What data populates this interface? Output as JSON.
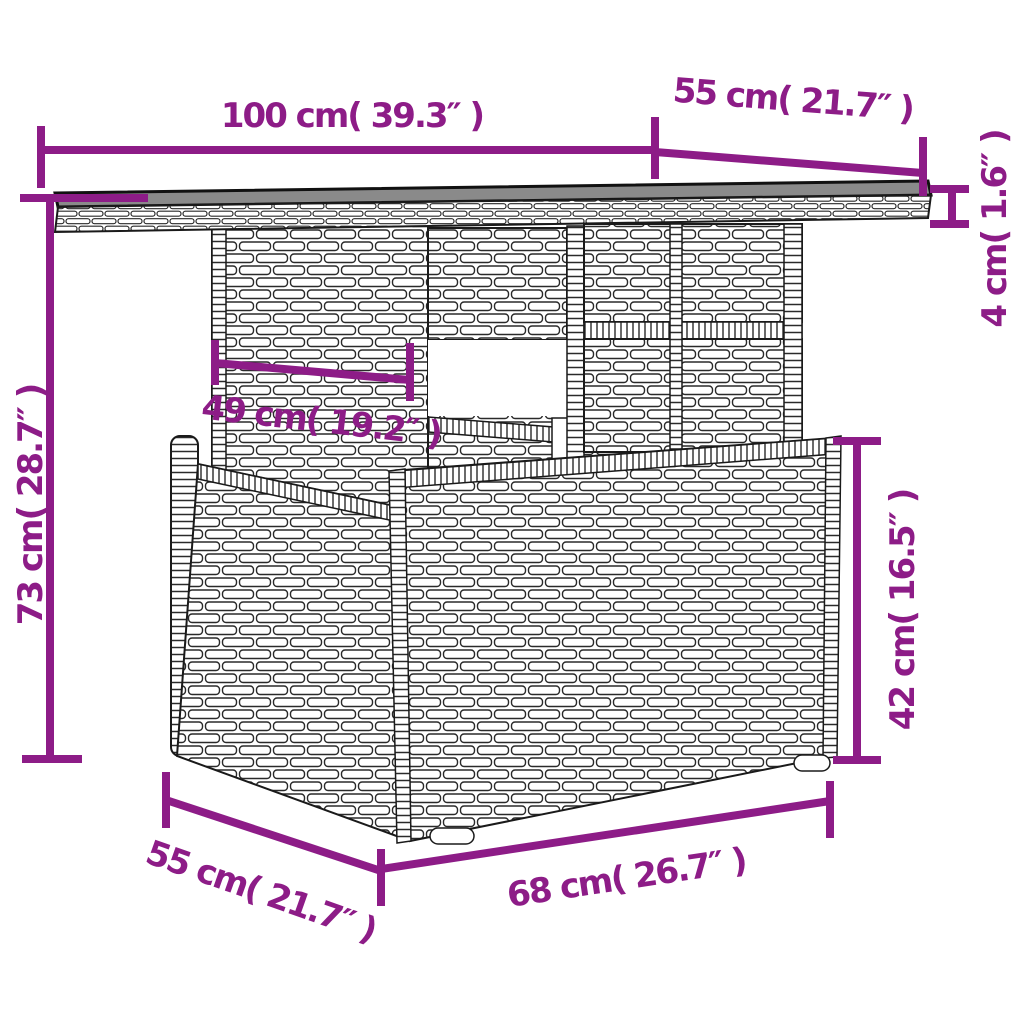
{
  "diagram": {
    "subject": "wicker garden table with lower storage box",
    "style": "line-art dimension drawing"
  },
  "colors": {
    "dimension": "#8d1c87",
    "outline": "#1a1a1a",
    "tabletop_surface": "#8a8a8a",
    "background": "#ffffff"
  },
  "labels": {
    "tabletop_width": "100 cm( 39.3″ )",
    "tabletop_depth": "55 cm( 21.7″ )",
    "tabletop_thickness": "4 cm( 1.6″ )",
    "overall_height": "73 cm( 28.7″ )",
    "support_width": "49 cm( 19.2″ )",
    "base_height": "42 cm( 16.5″ )",
    "base_depth": "55 cm( 21.7″ )",
    "base_width": "68 cm( 26.7″ )"
  },
  "measurements": [
    {
      "part": "tabletop width",
      "cm": 100,
      "inches": 39.3
    },
    {
      "part": "tabletop depth",
      "cm": 55,
      "inches": 21.7
    },
    {
      "part": "tabletop thickness",
      "cm": 4,
      "inches": 1.6
    },
    {
      "part": "overall height",
      "cm": 73,
      "inches": 28.7
    },
    {
      "part": "support width",
      "cm": 49,
      "inches": 19.2
    },
    {
      "part": "base height",
      "cm": 42,
      "inches": 16.5
    },
    {
      "part": "base depth",
      "cm": 55,
      "inches": 21.7
    },
    {
      "part": "base width",
      "cm": 68,
      "inches": 26.7
    }
  ]
}
